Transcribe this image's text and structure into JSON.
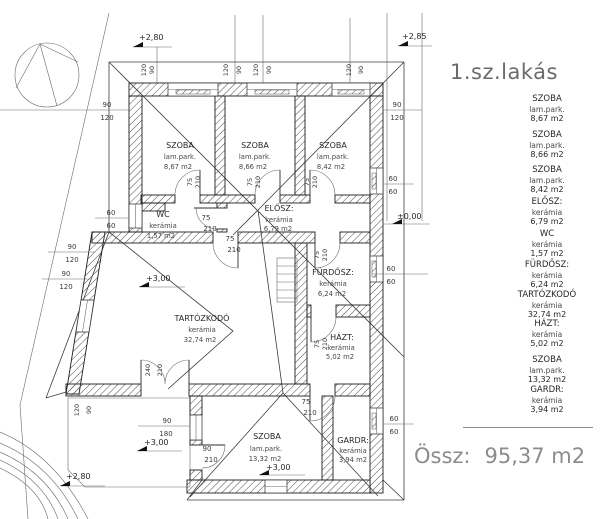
{
  "title": "1.sz.lakás",
  "total": {
    "label": "Össz:",
    "value": "95,37 m2"
  },
  "rooms": [
    {
      "id": "szoba1",
      "name": "SZOBA",
      "finish": "lam.park.",
      "area": "8,67 m2"
    },
    {
      "id": "szoba2",
      "name": "SZOBA",
      "finish": "lam.park.",
      "area": "8,66 m2"
    },
    {
      "id": "szoba3",
      "name": "SZOBA",
      "finish": "lam.park.",
      "area": "8,42 m2"
    },
    {
      "id": "elosz",
      "name": "ELŐSZ:",
      "finish": "kerámia",
      "area": "6,79 m2"
    },
    {
      "id": "wc",
      "name": "WC",
      "finish": "kerámia",
      "area": "1,57 m2"
    },
    {
      "id": "furdosz",
      "name": "FÜRDŐSZ:",
      "finish": "kerámia",
      "area": "6,24 m2"
    },
    {
      "id": "tartozkodo",
      "name": "TARTÓZKODÓ",
      "finish": "kerámia",
      "area": "32,74 m2"
    },
    {
      "id": "hazt",
      "name": "HÁZT:",
      "finish": "kerámia",
      "area": "5,02 m2"
    },
    {
      "id": "szoba4",
      "name": "SZOBA",
      "finish": "lam.park.",
      "area": "13,32 m2"
    },
    {
      "id": "gardr",
      "name": "GARDR:",
      "finish": "kerámia",
      "area": "3,94 m2"
    }
  ],
  "levels": {
    "top_left": "+2,80",
    "top_right": "+2,85",
    "entry": "±0,00",
    "living": "+3,00",
    "terrace": "+3,00",
    "terrace_corner": "+2,80",
    "bedroom": "+3,00"
  },
  "dims": {
    "n60": "60",
    "n75": "75",
    "n90": "90",
    "n120": "120",
    "n180": "180",
    "n210": "210",
    "n240": "240"
  }
}
